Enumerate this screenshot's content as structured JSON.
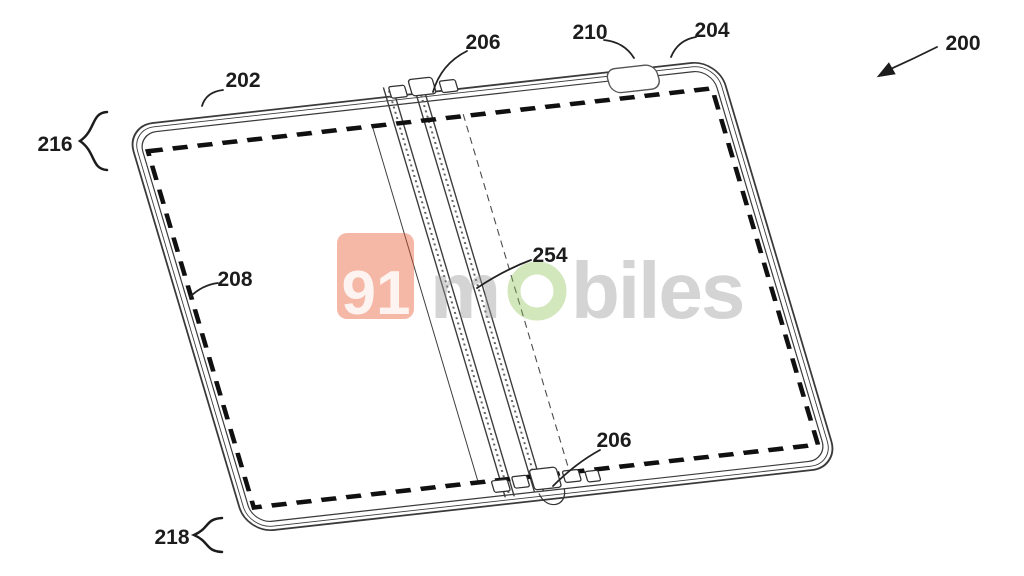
{
  "figure": {
    "ref_labels": {
      "device": "200",
      "top_edge": "202",
      "corner_edge": "204",
      "hinge_top": "206",
      "hinge_bottom": "206",
      "display_border": "208",
      "camera": "210",
      "first_portion": "216",
      "second_portion": "218",
      "fold_region": "254"
    }
  },
  "watermark": {
    "badge": "91",
    "m": "m",
    "rest": "biles"
  },
  "colors": {
    "background": "#ffffff",
    "line": "#2a2a2a",
    "badge_red": "#e8552e",
    "ring_green": "#8cc152",
    "watermark_gray": "#9a9a9a"
  }
}
